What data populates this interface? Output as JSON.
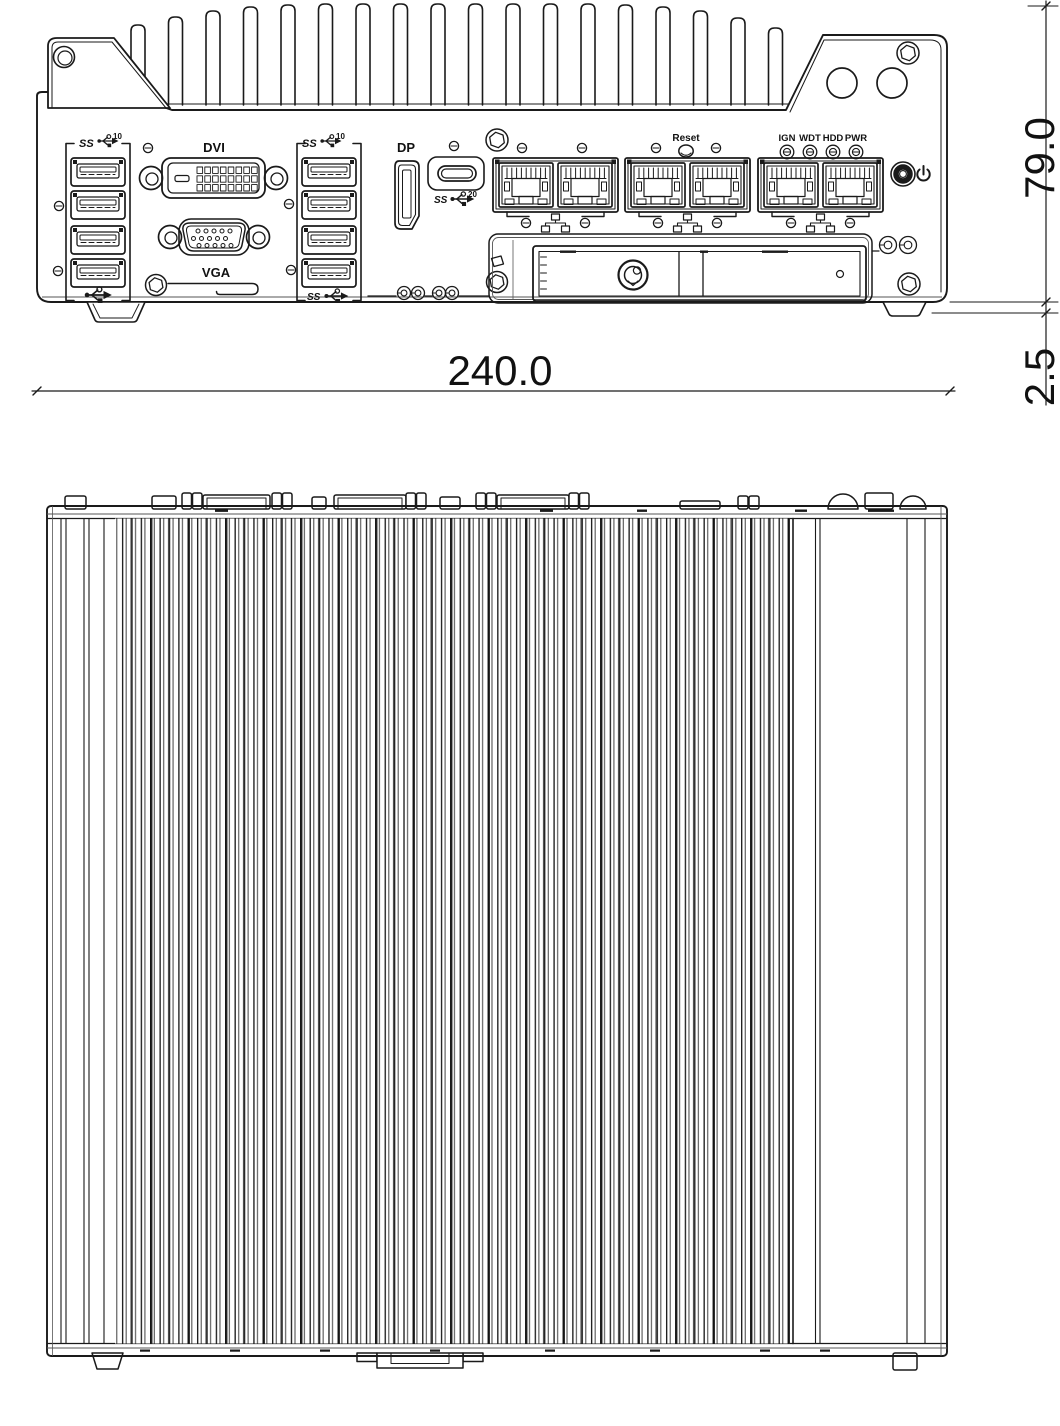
{
  "front_panel": {
    "labels": {
      "dvi": "DVI",
      "vga": "VGA",
      "dp": "DP",
      "reset": "Reset"
    },
    "led_labels": [
      "IGN",
      "WDT",
      "HDD",
      "PWR"
    ],
    "usb_badges": {
      "ss": "SS",
      "gen10": "10",
      "gen20": "20"
    }
  },
  "dimensions": {
    "width": "240.0",
    "height": "79.0",
    "foot": "2.5"
  },
  "colors": {
    "line": "#1a1a1a",
    "line_soft": "#555555",
    "text": "#111111",
    "background": "#ffffff"
  }
}
